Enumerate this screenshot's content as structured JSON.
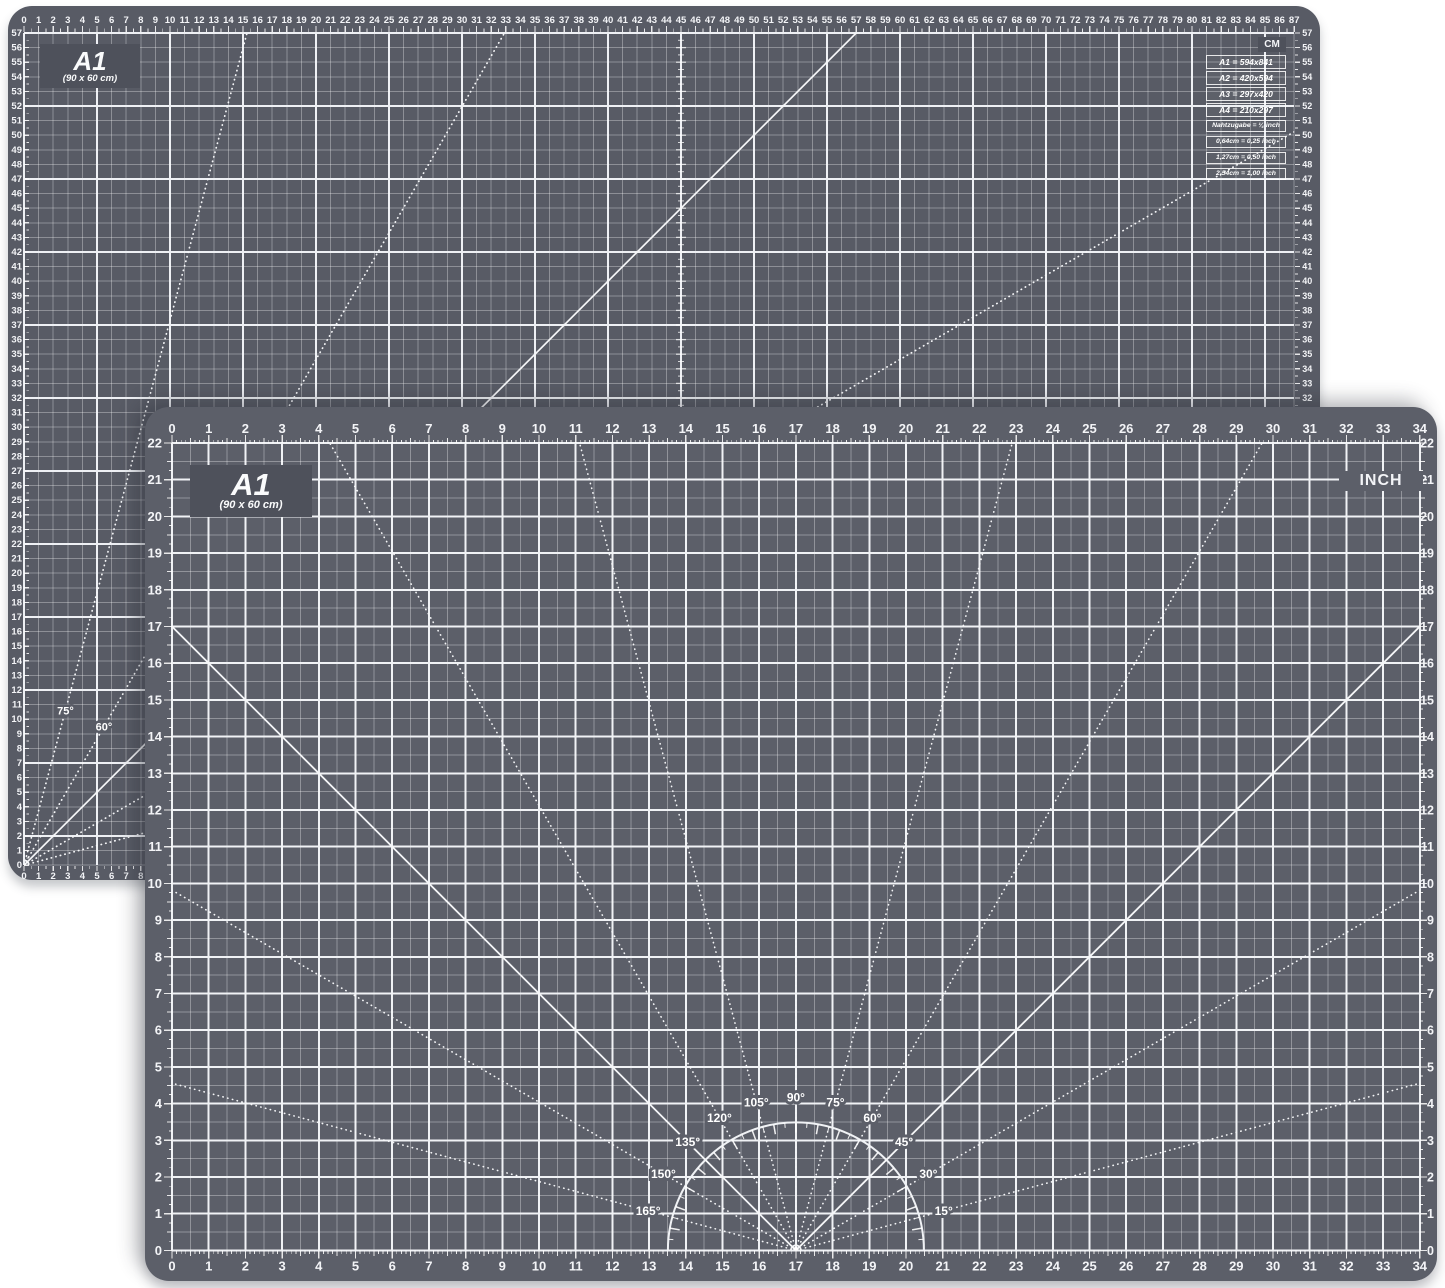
{
  "back_mat": {
    "title": "A1",
    "subtitle": "(90 x 60 cm)",
    "unit_label": "CM",
    "ruler_x_from": 0,
    "ruler_x_to": 87,
    "ruler_y_from": 0,
    "ruler_y_to": 57,
    "center_ruler_cm": 45,
    "fan": {
      "angles_deg": [
        15,
        30,
        45,
        60,
        75
      ],
      "solid_deg": [
        45
      ],
      "labels": [
        {
          "text": "75°",
          "deg": 75
        },
        {
          "text": "60°",
          "deg": 60
        }
      ]
    },
    "size_table_large": [
      "A1 = 594x841",
      "A2 = 420x594",
      "A3 = 297x420",
      "A4 = 210x297"
    ],
    "size_table_small": [
      "Nahtzugabe = ¼ inch",
      "0,64cm = 0,25 inch",
      "1,27cm = 0,50 inch",
      "2,54cm = 1,00 inch"
    ],
    "colors": {
      "surface": "#585b65",
      "label_box": "#4e515b",
      "line_major": "#eef0f4",
      "line_minor": "rgba(255,255,255,0.32)"
    }
  },
  "front_mat": {
    "title": "A1",
    "subtitle": "(90 x 60 cm)",
    "unit_label": "INCH",
    "ruler_x_from": 0,
    "ruler_x_to": 34,
    "ruler_y_from": 0,
    "ruler_y_to": 22,
    "protractor": {
      "center_x_in": 17,
      "angles_deg": [
        15,
        30,
        45,
        60,
        75,
        90,
        105,
        120,
        135,
        150,
        165
      ],
      "solid_deg": [
        45,
        135
      ],
      "labels": [
        {
          "text": "15°",
          "deg": 15
        },
        {
          "text": "30°",
          "deg": 30
        },
        {
          "text": "45°",
          "deg": 45
        },
        {
          "text": "60°",
          "deg": 60
        },
        {
          "text": "75°",
          "deg": 75
        },
        {
          "text": "90°",
          "deg": 90
        },
        {
          "text": "105°",
          "deg": 105
        },
        {
          "text": "120°",
          "deg": 120
        },
        {
          "text": "135°",
          "deg": 135
        },
        {
          "text": "150°",
          "deg": 150
        },
        {
          "text": "165°",
          "deg": 165
        }
      ]
    },
    "colors": {
      "surface": "#5c5f69",
      "label_box": "#4e515b",
      "line_major": "#f0f2f5",
      "line_minor": "rgba(255,255,255,0.33)"
    }
  }
}
